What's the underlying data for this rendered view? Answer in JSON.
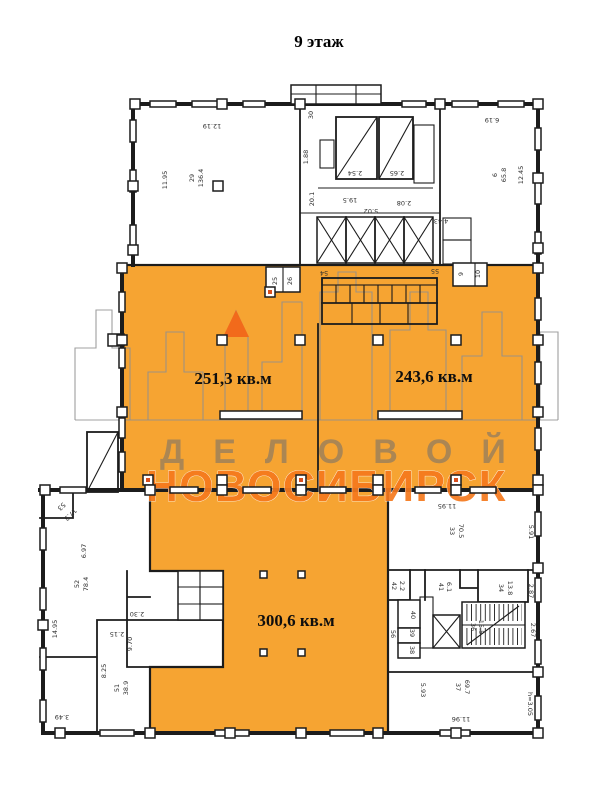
{
  "title": "9 этаж",
  "watermark": {
    "line1": "ДЕЛОВОЙ",
    "line2": "НОВОСИБИРСК",
    "line1_color": "#6f6f6f",
    "line2_color": "#f5791d"
  },
  "colors": {
    "highlight_orange": "#f6a432",
    "logo_triangle_orange": "#f26a1b",
    "wall_black": "#1c1c1c",
    "skyline_gray": "#8f8f8f"
  },
  "areas": {
    "left_unit": "251,3 кв.м",
    "right_unit": "243,6 кв.м",
    "bottom_unit": "300,6 кв.м"
  },
  "labels": [
    {
      "text": "12.19"
    },
    {
      "text": "11.95"
    },
    {
      "text": "29"
    },
    {
      "text": "136.4"
    },
    {
      "text": "30"
    },
    {
      "text": "1.88"
    },
    {
      "text": "2.54"
    },
    {
      "text": "2.65"
    },
    {
      "text": "20.1"
    },
    {
      "text": "19.5"
    },
    {
      "text": "5.02"
    },
    {
      "text": "2.08"
    },
    {
      "text": "4.43"
    },
    {
      "text": "6.19"
    },
    {
      "text": "6"
    },
    {
      "text": "65.8"
    },
    {
      "text": "12.45"
    },
    {
      "text": "25"
    },
    {
      "text": "26"
    },
    {
      "text": "54"
    },
    {
      "text": "55"
    },
    {
      "text": "9"
    },
    {
      "text": "10"
    },
    {
      "text": "53"
    },
    {
      "text": "17.3"
    },
    {
      "text": "6.97"
    },
    {
      "text": "52"
    },
    {
      "text": "78.4"
    },
    {
      "text": "14.95"
    },
    {
      "text": "2.30"
    },
    {
      "text": "2.15"
    },
    {
      "text": "9.70"
    },
    {
      "text": "8.25"
    },
    {
      "text": "51"
    },
    {
      "text": "38.9"
    },
    {
      "text": "3.49"
    },
    {
      "text": "11.95"
    },
    {
      "text": "33"
    },
    {
      "text": "70.5"
    },
    {
      "text": "5.91"
    },
    {
      "text": "42"
    },
    {
      "text": "2.2"
    },
    {
      "text": "41"
    },
    {
      "text": "6.1"
    },
    {
      "text": "34"
    },
    {
      "text": "13.8"
    },
    {
      "text": "2.87"
    },
    {
      "text": "40"
    },
    {
      "text": "56"
    },
    {
      "text": "39"
    },
    {
      "text": "38"
    },
    {
      "text": "36"
    },
    {
      "text": "15.5"
    },
    {
      "text": "2.67"
    },
    {
      "text": "5.93"
    },
    {
      "text": "37"
    },
    {
      "text": "69.7"
    },
    {
      "text": "11.96"
    },
    {
      "text": "h=3.05"
    }
  ]
}
